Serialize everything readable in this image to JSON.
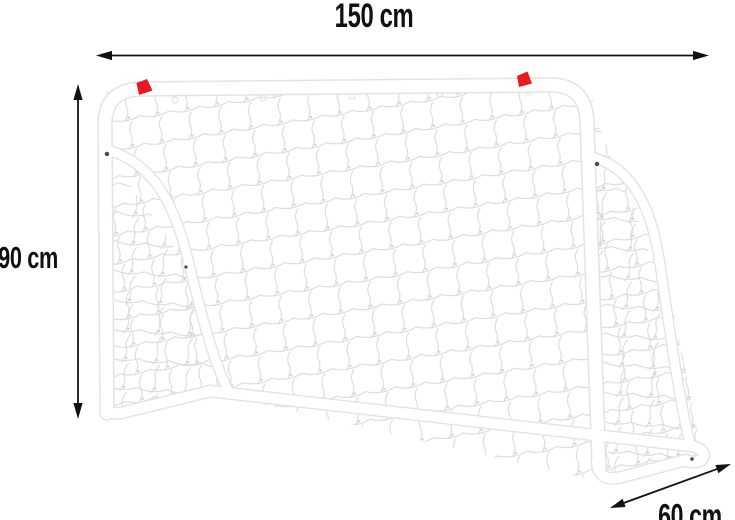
{
  "diagram": {
    "object": "soccer-goal-with-net-dimension-diagram",
    "dimensions": {
      "width": "150 cm",
      "height": "90 cm",
      "depth": "60 cm"
    },
    "flags": {
      "count": 2,
      "color_name": "red"
    },
    "colors": {
      "arrow": "#121212",
      "label_text": "#111111",
      "frame_outline": "#e3e3e3",
      "frame_fill": "#ffffff",
      "net": "#dadada",
      "net_knot": "#d0d0d0",
      "flag_red": "#e8191f",
      "screw": "#4a4a4a",
      "background": "#ffffff"
    }
  }
}
